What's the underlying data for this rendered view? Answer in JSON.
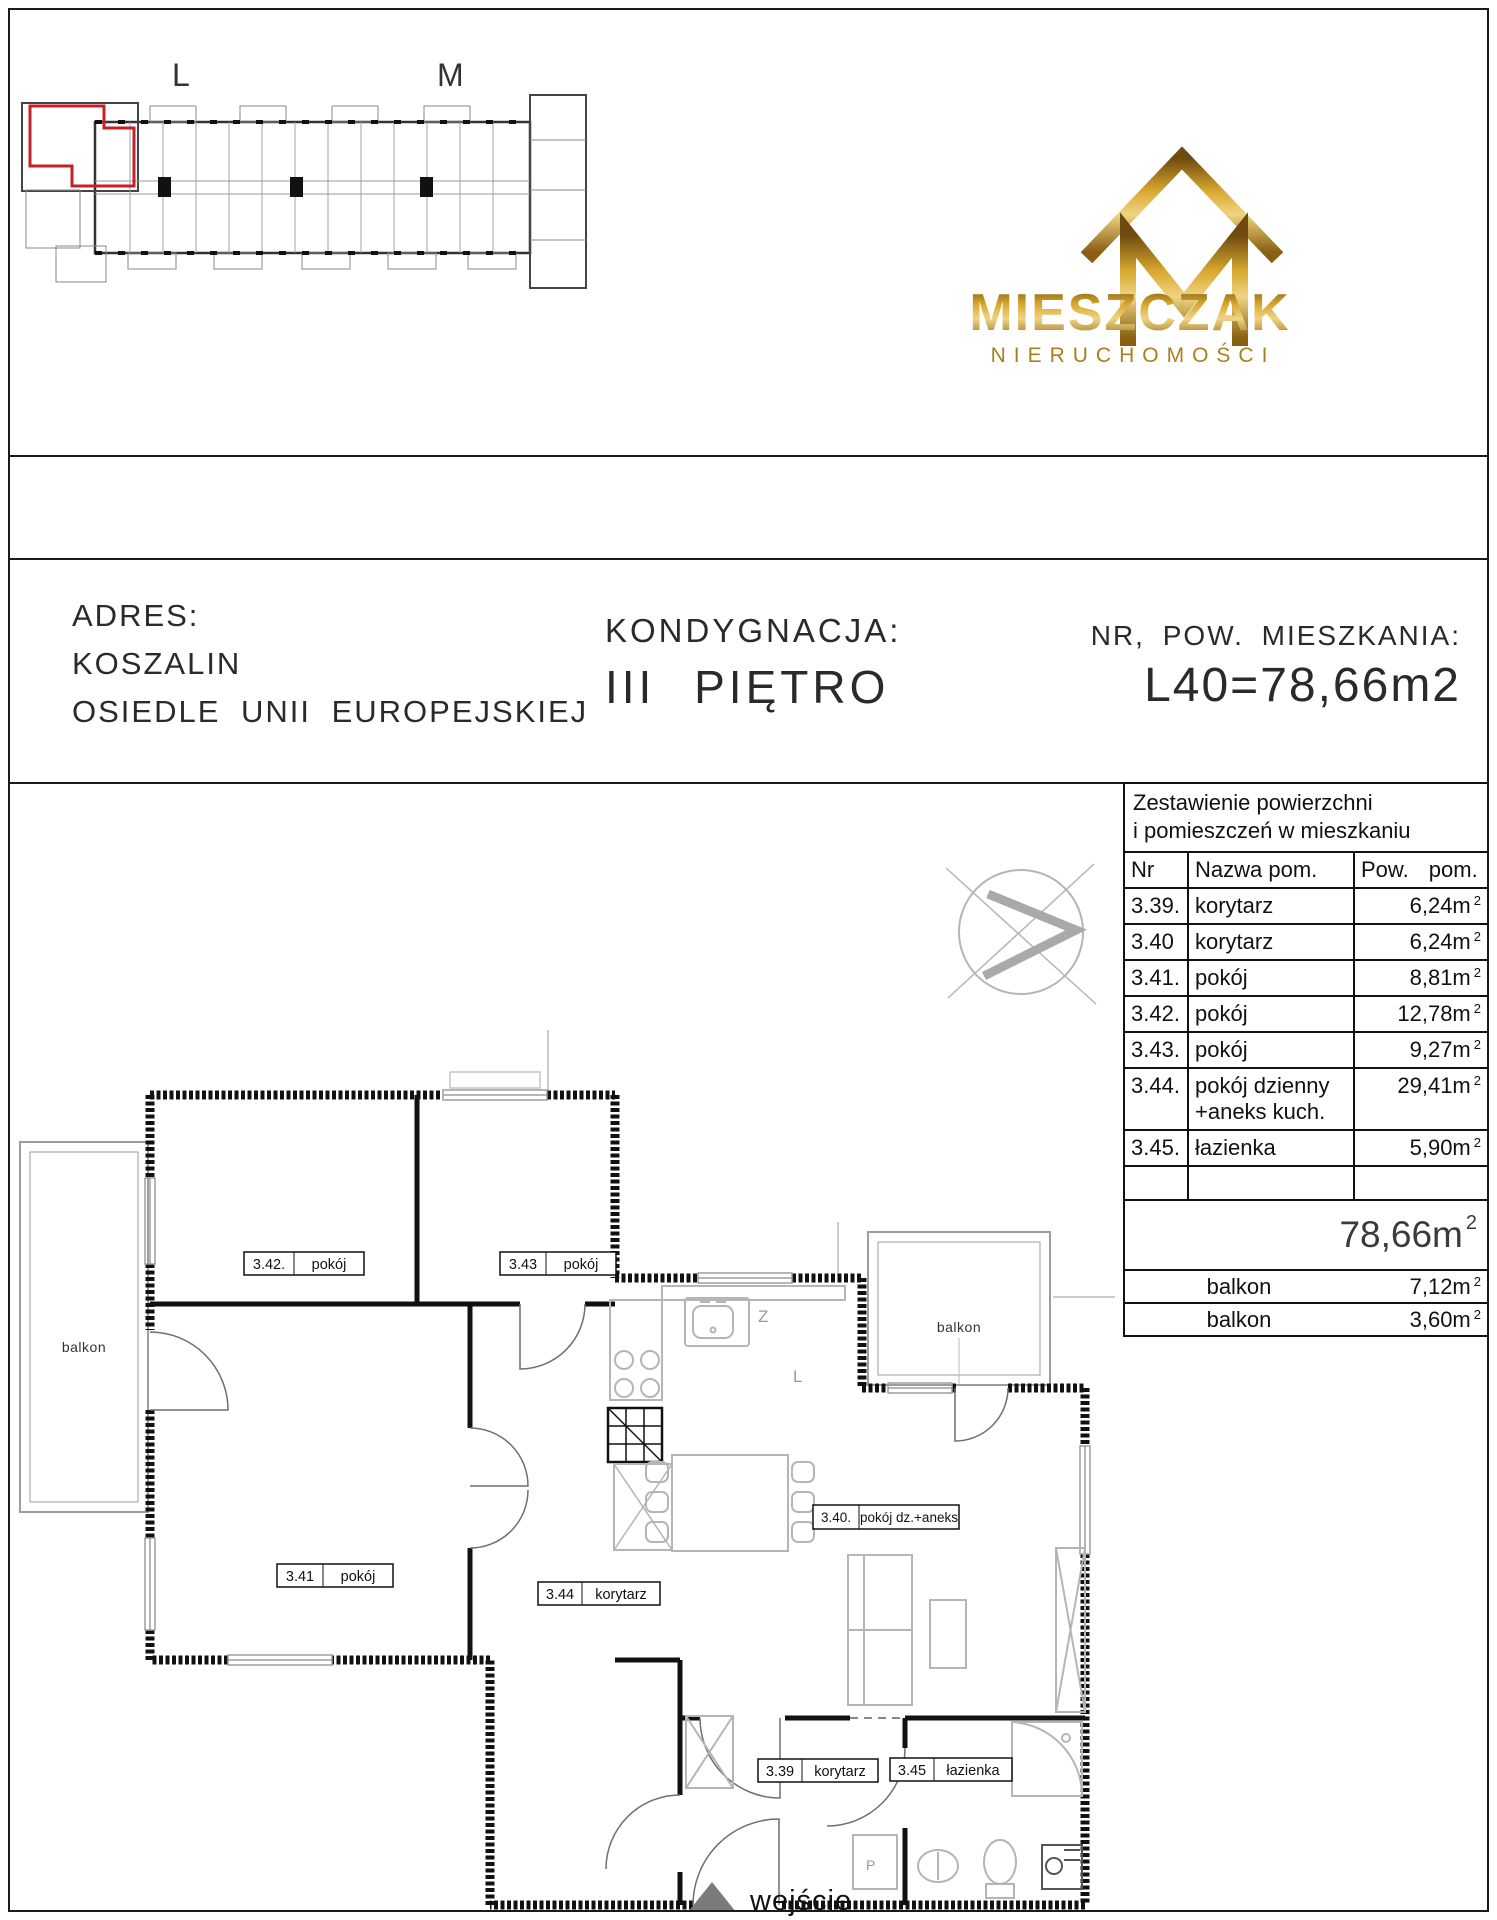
{
  "colors": {
    "accent_red": "#c42127",
    "gold": "#b07d1e",
    "wall": "#111111"
  },
  "overview": {
    "label_l": "L",
    "label_m": "M"
  },
  "logo": {
    "brand": "MIESZCZAK",
    "subtitle": "NIERUCHOMOŚCI"
  },
  "address": {
    "label": "ADRES:",
    "city": "KOSZALIN",
    "estate": "OSIEDLE UNII EUROPEJSKIEJ"
  },
  "floor": {
    "label": "KONDYGNACJA:",
    "value": "III PIĘTRO"
  },
  "apartment": {
    "label": "NR, POW. MIESZKANIA:",
    "value": "L40=78,66m2"
  },
  "table": {
    "title_line1": "Zestawienie powierzchni",
    "title_line2": "i pomieszczeń w mieszkaniu",
    "col_nr": "Nr",
    "col_name": "Nazwa pom.",
    "col_area": "Pow. pom.",
    "sup": "2",
    "rows": [
      {
        "nr": "3.39.",
        "name": "korytarz",
        "area": "6,24m"
      },
      {
        "nr": "3.40",
        "name": "korytarz",
        "area": "6,24m"
      },
      {
        "nr": "3.41.",
        "name": "pokój",
        "area": "8,81m"
      },
      {
        "nr": "3.42.",
        "name": "pokój",
        "area": "12,78m"
      },
      {
        "nr": "3.43.",
        "name": "pokój",
        "area": "9,27m"
      },
      {
        "nr": "3.44.",
        "name": "pokój dzienny\n+aneks kuch.",
        "area": "29,41m"
      },
      {
        "nr": "3.45.",
        "name": "łazienka",
        "area": "5,90m"
      }
    ],
    "total": "78,66m",
    "extras": [
      {
        "name": "balkon",
        "area": "7,12m"
      },
      {
        "name": "balkon",
        "area": "3,60m"
      }
    ]
  },
  "plan": {
    "rooms": {
      "r342": {
        "nr": "3.42.",
        "name": "pokój"
      },
      "r343": {
        "nr": "3.43",
        "name": "pokój"
      },
      "r341": {
        "nr": "3.41",
        "name": "pokój"
      },
      "r344": {
        "nr": "3.44",
        "name": "korytarz"
      },
      "r340": {
        "nr": "3.40.",
        "name": "pokój dz.+aneks"
      },
      "r339": {
        "nr": "3.39",
        "name": "korytarz"
      },
      "r345": {
        "nr": "3.45",
        "name": "łazienka"
      }
    },
    "balcony_left": "balkon",
    "balcony_right": "balkon",
    "entrance": "wejście",
    "kitchen_sink_mark": "Z",
    "kitchen_mark": "L",
    "washer_mark": "P"
  }
}
